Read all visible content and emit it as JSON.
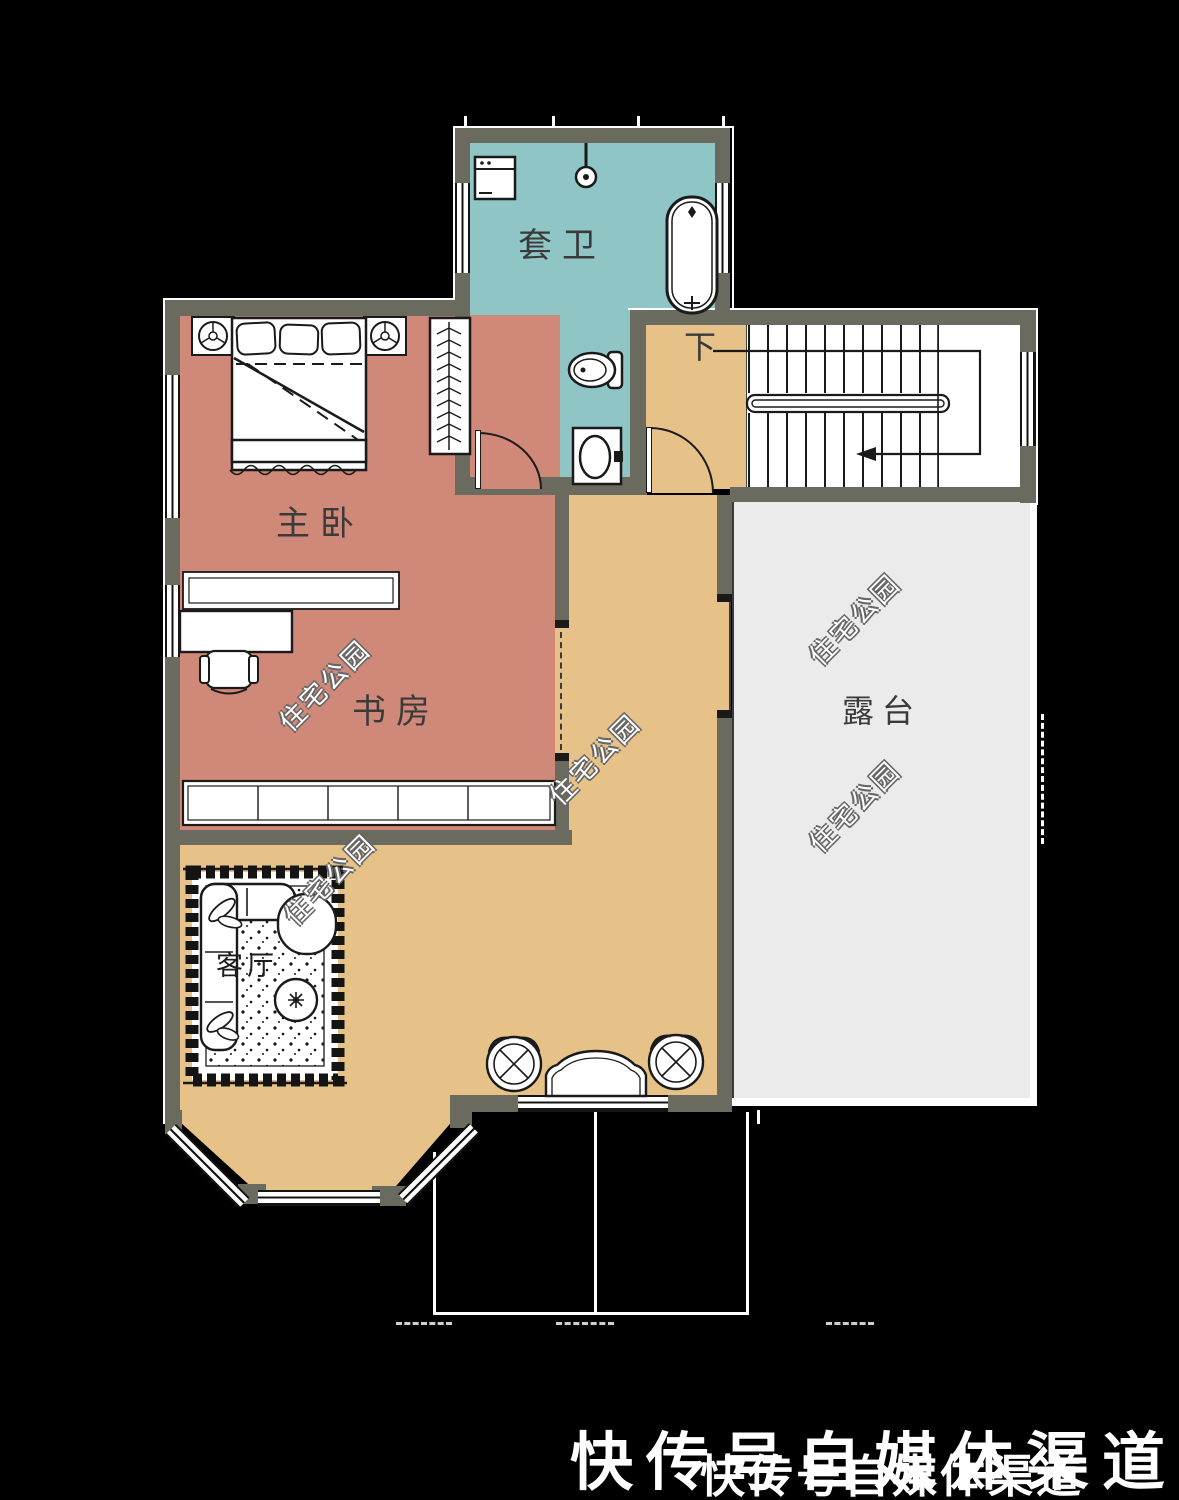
{
  "plan_title": "second-floor-plan",
  "rooms": {
    "bathroom": {
      "label": "套卫"
    },
    "master_bedroom": {
      "label": "主卧"
    },
    "study": {
      "label": "书房"
    },
    "stairs_down": {
      "label": "下"
    },
    "terrace": {
      "label": "露台"
    },
    "living_room": {
      "label": "客厅"
    }
  },
  "watermark": {
    "text": "住宅公园"
  },
  "footer": {
    "text_large": "快传号自媒体渠道",
    "text_small": "快传号自媒体渠道"
  },
  "colors": {
    "wall": "#6b6a5e",
    "bath": "#8fc5c4",
    "bed": "#d08978",
    "hall": "#e6c289",
    "terrace": "#ebebeb",
    "bg": "#000000",
    "line": "#1a1a1a"
  }
}
